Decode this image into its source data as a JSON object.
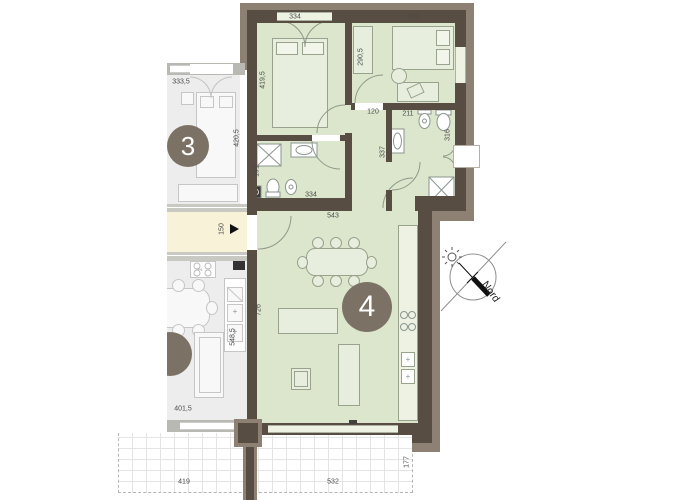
{
  "units": {
    "unit3": {
      "number": "3"
    },
    "unit4": {
      "number": "4"
    }
  },
  "compass": {
    "label": "Nord"
  },
  "kitchen3": {
    "stove_label": "PL"
  },
  "dimensions": [
    {
      "t": "334",
      "x": 295,
      "y": 17,
      "v": 0
    },
    {
      "t": "342",
      "x": 413,
      "y": 17,
      "v": 0
    },
    {
      "t": "419,5",
      "x": 263,
      "y": 80,
      "v": 1
    },
    {
      "t": "290,5",
      "x": 361,
      "y": 57,
      "v": 1
    },
    {
      "t": "333,5",
      "x": 181,
      "y": 82,
      "v": 0
    },
    {
      "t": "420,5",
      "x": 237,
      "y": 138,
      "v": 1
    },
    {
      "t": "120",
      "x": 373,
      "y": 112,
      "v": 0
    },
    {
      "t": "211",
      "x": 408,
      "y": 114,
      "v": 0
    },
    {
      "t": "316",
      "x": 448,
      "y": 135,
      "v": 1
    },
    {
      "t": "337",
      "x": 383,
      "y": 152,
      "v": 1
    },
    {
      "t": "191",
      "x": 257,
      "y": 171,
      "v": 1
    },
    {
      "t": "334",
      "x": 311,
      "y": 195,
      "v": 0
    },
    {
      "t": "543",
      "x": 333,
      "y": 216,
      "v": 0
    },
    {
      "t": "150",
      "x": 222,
      "y": 229,
      "v": 1
    },
    {
      "t": "726",
      "x": 259,
      "y": 310,
      "v": 1
    },
    {
      "t": "548,5",
      "x": 233,
      "y": 337,
      "v": 1
    },
    {
      "t": "401,5",
      "x": 183,
      "y": 409,
      "v": 0
    },
    {
      "t": "419",
      "x": 184,
      "y": 482,
      "v": 0
    },
    {
      "t": "532",
      "x": 333,
      "y": 482,
      "v": 0
    },
    {
      "t": "177",
      "x": 407,
      "y": 462,
      "v": 1
    }
  ],
  "colors": {
    "wall_dark": "#584d43",
    "wall_taupe": "#8d8173",
    "unit4_fill": "#dbe6cc",
    "unit4_window": "#eef2e3",
    "unit3_fill": "#ededed",
    "unit3_wall": "#b9b9b3",
    "corridor_fill": "#f8f3d8",
    "circle_fill": "#7b7265",
    "dimension_text": "#4a4a4a"
  }
}
